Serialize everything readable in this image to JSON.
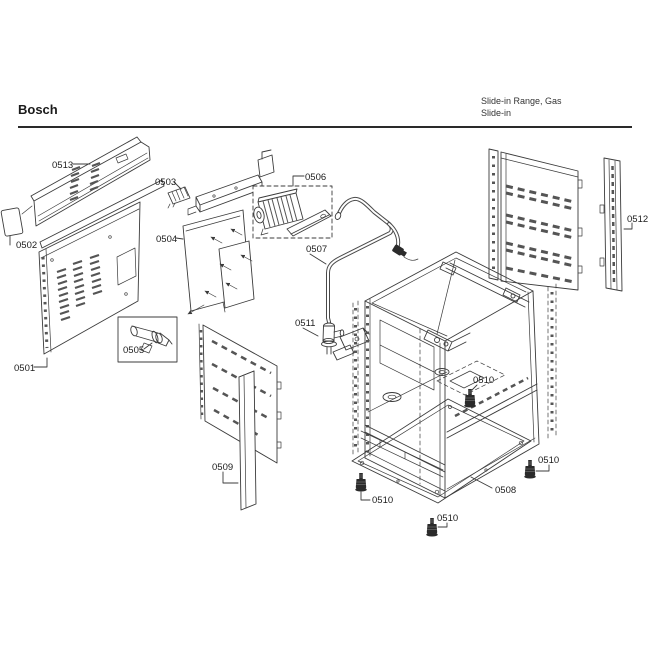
{
  "header": {
    "brand": "Bosch",
    "product_line1": "Slide-in Range, Gas",
    "product_line2": "Slide-in"
  },
  "diagram": {
    "labels": [
      "0513",
      "0503",
      "0506",
      "0512",
      "0502",
      "0504",
      "0507",
      "0511",
      "0501",
      "0505",
      "0510",
      "0509",
      "0510",
      "0508",
      "0510",
      "0510"
    ]
  },
  "colors": {
    "line": "#3b3b3b",
    "text": "#1c1c1c",
    "background": "#ffffff"
  }
}
